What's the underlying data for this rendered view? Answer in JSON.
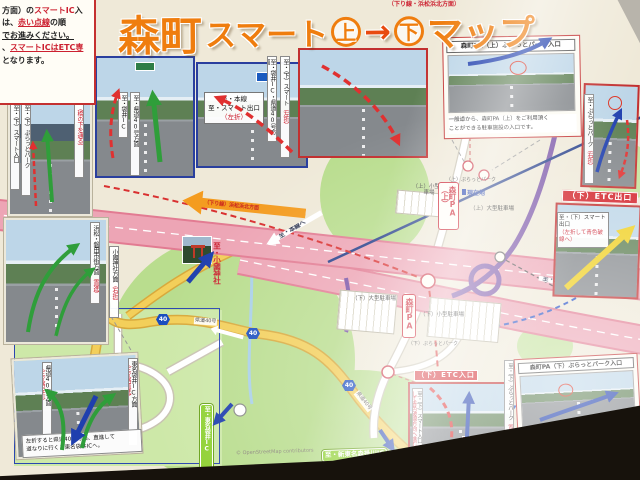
{
  "notice": {
    "l1a": "方面）の",
    "l1r": "スマートIC",
    "l1b": "入",
    "l2a": "は、",
    "l2r": "赤い点線",
    "l2b": "の順",
    "l3": "でお進みください。",
    "l4a": "、",
    "l4r": "スマートICはETC専",
    "l5": "となります。"
  },
  "title": {
    "pre": "（下り線・浜松浜北方面）",
    "t1": "森町",
    "t2": "スマート",
    "c1": "上",
    "arrow": "→",
    "c2": "下",
    "t3": "マップ"
  },
  "photos": {
    "ue_entry": {
      "s1": "至・袋井IC",
      "s2": "至・県道40号方面"
    },
    "mainline": {
      "l1": "至・本線",
      "l2": "至・スマート出口",
      "l3": "（左折）"
    },
    "shita_exit": {
      "s1": "至・袋井IC・県道40号方面",
      "s2a": "至・（下）スマート",
      "s2r": "（左折）"
    },
    "underpass": {
      "s1": "至・（下）スマート入口",
      "s2": "至・（下）ぷらっとパーク",
      "note": "（橋の下を通る）"
    },
    "city": {
      "s1a": "浜松・磐田市街方面",
      "s1r": "（直進）",
      "s2a": "小國神社方面",
      "s2r": "（右折）"
    },
    "fork": {
      "s1a": "県道40号方面",
      "s1r": "（三叉路左折）",
      "s2a": "東名袋井IC方面",
      "s2r": "（三叉路直進）",
      "cap1": "左折すると県道40号方面、直進して",
      "cap2": "道なりに行くと東名袋井ICへ。"
    },
    "pa_ue": {
      "title": "森町PA（上）ぷらっとパーク入口",
      "cap1": "一般道から、森町PA（上）をご利用頂く",
      "cap2": "ことができる駐車施設の入口です。"
    },
    "platpark_ue": {
      "s1a": "至・ぷらっとパーク",
      "s1r": "（右折）"
    },
    "etc_exit": {
      "banner": "（下）ETC出口",
      "l1": "至・（下）スマート出口",
      "l2": "（左折して青色破線へ）"
    },
    "etc_in": {
      "banner": "（下）ETC入口",
      "s1a": "至・（下）スマート入口",
      "s1r": "（左折して青色破線方向へ進む）",
      "nagoya": "名古屋方面"
    },
    "pa_shita": {
      "title": "森町PA（下）ぷらっとパーク入口",
      "cap1": "一般道から、森町PA（下）をご利用頂く",
      "cap2": "ことができる駐車施設の入口です。",
      "s1a": "至・（下）ぷらっとパーク",
      "s1r": "（直進）"
    }
  },
  "map": {
    "pa_ue_box": "森町PA（上）",
    "genzaichi": "現在地",
    "lot_ue_small": "（上）小型駐車場",
    "lot_ue_large": "（上）大型駐車場",
    "platpark_ue": "（上）ぷらっとパーク",
    "pa_box": "森町PA",
    "lot_dn_large": "（下）大型駐車場",
    "lot_dn_small": "（下）小型駐車場",
    "platpark_dn": "（下）ぷらっとパーク",
    "okuni": "至・小國神社",
    "hamamatsu": "浜松・磐田市街方面",
    "tomei": "至・東名袋井IC",
    "morikake": "至・新東名森掛川IC",
    "shin_tomei": "（下り線）浜松浜北方面",
    "to_mainline": "至・本線へ",
    "to_mainline2": "至・本線へ",
    "r40": "40",
    "road40": "県道40号",
    "credit": "© OpenStreetMap contributors"
  }
}
